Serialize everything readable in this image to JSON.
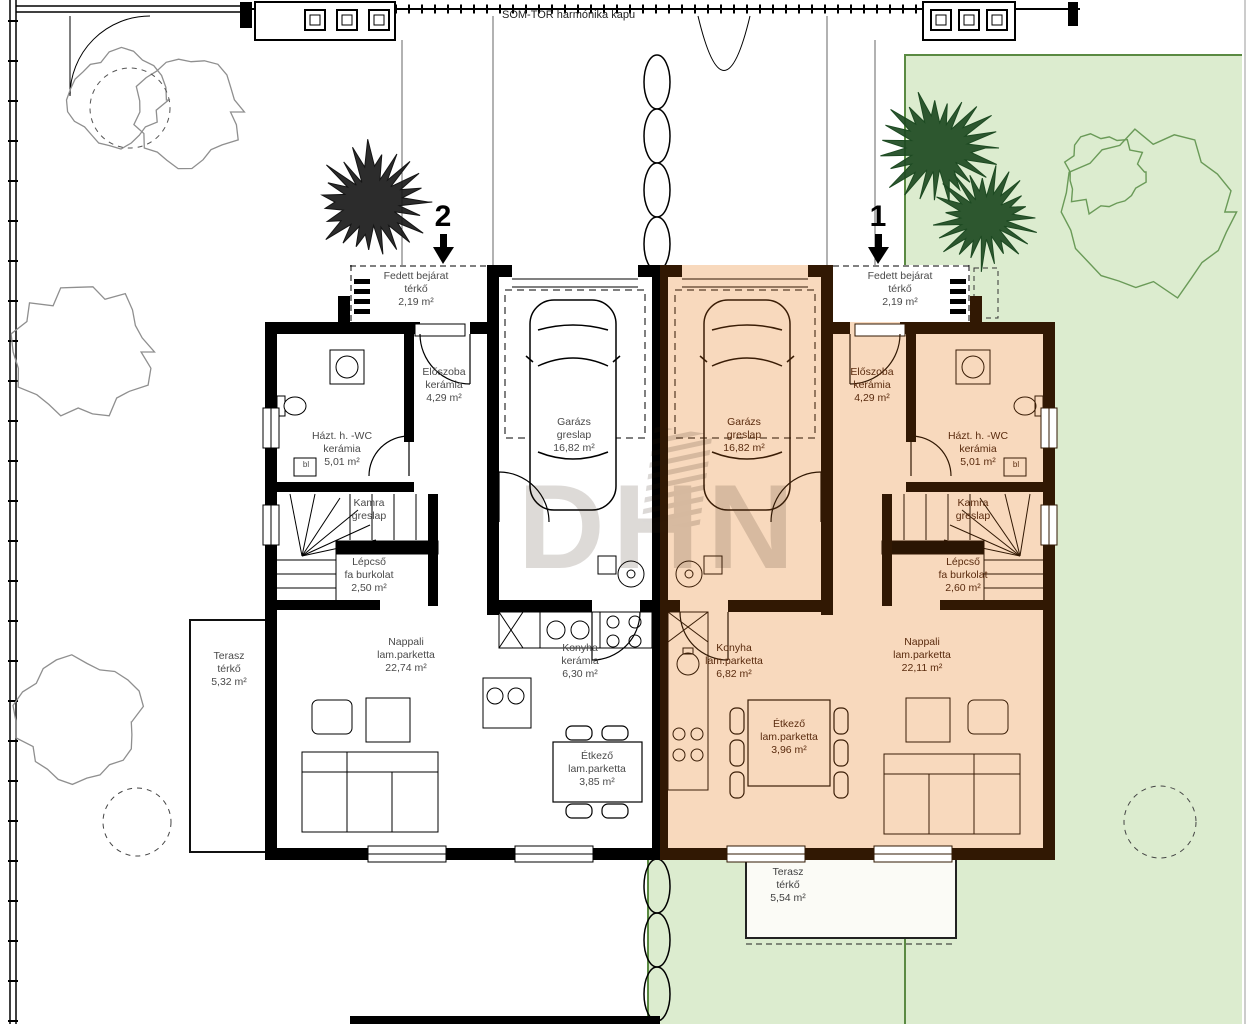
{
  "site": {
    "gate_label": "SOM-TOR  harmónika kapu",
    "watermark": "DHN"
  },
  "left_unit": {
    "number": "2",
    "fedett_bejarat": {
      "name": "Fedett bejárat",
      "material": "térkő",
      "area": "2,19 m²"
    },
    "eloszoba": {
      "name": "Előszoba",
      "material": "kerámia",
      "area": "4,29 m²"
    },
    "hazt_wc": {
      "name": "Házt. h. -WC",
      "material": "kerámia",
      "area": "5,01 m²"
    },
    "kamra": {
      "name": "Kamra",
      "material": "greslap"
    },
    "lepcso": {
      "name": "Lépcső",
      "material": "fa burkolat",
      "area": "2,50 m²"
    },
    "garazs": {
      "name": "Garázs",
      "material": "greslap",
      "area": "16,82 m²"
    },
    "nappali": {
      "name": "Nappali",
      "material": "lam.parketta",
      "area": "22,74 m²"
    },
    "konyha": {
      "name": "Konyha",
      "material": "kerámia",
      "area": "6,30 m²"
    },
    "etkezo": {
      "name": "Étkező",
      "material": "lam.parketta",
      "area": "3,85 m²"
    },
    "terasz": {
      "name": "Terasz",
      "material": "térkő",
      "area": "5,32 m²"
    },
    "bojler": "bl"
  },
  "right_unit": {
    "number": "1",
    "fedett_bejarat": {
      "name": "Fedett bejárat",
      "material": "térkő",
      "area": "2,19 m²"
    },
    "eloszoba": {
      "name": "Előszoba",
      "material": "kerámia",
      "area": "4,29 m²"
    },
    "hazt_wc": {
      "name": "Házt. h. -WC",
      "material": "kerámia",
      "area": "5,01 m²"
    },
    "kamra": {
      "name": "Kamra",
      "material": "greslap"
    },
    "lepcso": {
      "name": "Lépcső",
      "material": "fa burkolat",
      "area": "2,60 m²"
    },
    "garazs": {
      "name": "Garázs",
      "material": "greslap",
      "area": "16,82 m²"
    },
    "nappali": {
      "name": "Nappali",
      "material": "lam.parketta",
      "area": "22,11 m²"
    },
    "konyha": {
      "name": "Konyha",
      "material": "lam.parketta",
      "area": "6,82 m²"
    },
    "etkezo": {
      "name": "Étkező",
      "material": "lam.parketta",
      "area": "3,96 m²"
    },
    "terasz": {
      "name": "Terasz",
      "material": "térkő",
      "area": "5,54 m²"
    },
    "bojler": "bl"
  },
  "colors": {
    "garden_green": "#dceccf",
    "garden_border": "#5a8a42",
    "right_unit_floor": "#f8d9bd",
    "right_unit_wall": "#311803",
    "left_unit_wall": "#000000"
  }
}
